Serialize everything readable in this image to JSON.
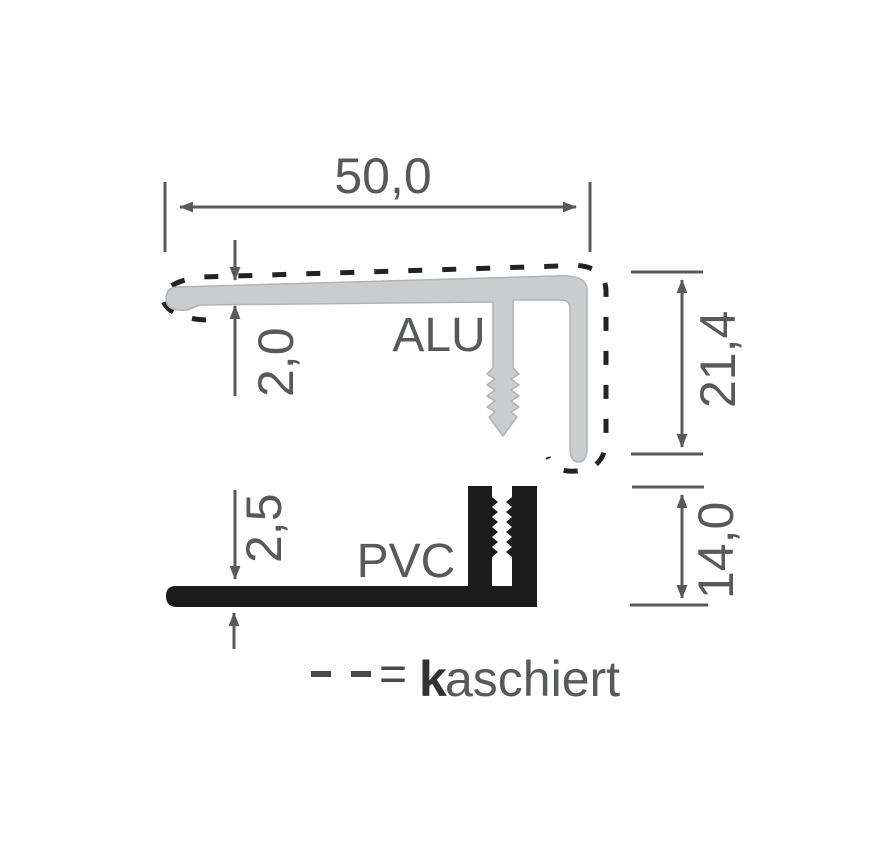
{
  "diagram": {
    "title_context": "profile-cross-section-drawing",
    "labels": {
      "alu": "ALU",
      "pvc": "PVC"
    },
    "dimensions": {
      "top_width": "50,0",
      "alu_thickness": "2,0",
      "alu_height": "21,4",
      "pvc_thickness": "2,5",
      "pvc_height": "14,0"
    },
    "legend": {
      "equals": "=",
      "term_bold": "k",
      "term_rest": "aschiert"
    },
    "colors": {
      "background": "#ffffff",
      "alu_fill": "#cbccce",
      "alu_stroke": "#b2b3b5",
      "pvc_fill": "#1b1b1b",
      "dim": "#58595b",
      "dash": "#232323",
      "dash_legend": "#47484a",
      "legend_bold": "#313234"
    }
  }
}
